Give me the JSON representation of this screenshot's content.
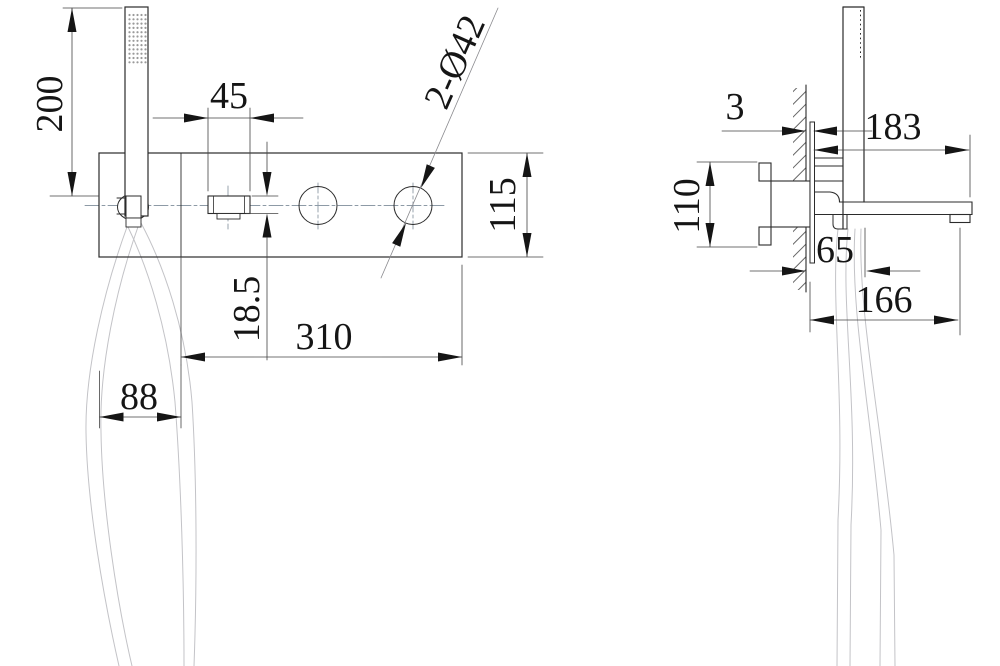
{
  "title": "bath-shower-mixer-technical-drawing",
  "front_view": {
    "dim_handset_height": "200",
    "dim_handle_width": "45",
    "dim_hole_note": "2-Ø42",
    "dim_plate_height": "115",
    "dim_handle_thickness": "18.5",
    "dim_plate_length": "310",
    "dim_holder_section": "88"
  },
  "side_view": {
    "dim_wall_plate_thickness": "3",
    "dim_spout_reach": "183",
    "dim_body_height": "110",
    "dim_hose_offset": "65",
    "dim_lower_reach": "166"
  },
  "colors": {
    "outline": "#2b2b2b",
    "thin_line": "#444444",
    "hose": "#c3c3c7",
    "centerline": "#8d9aa6",
    "background": "#ffffff"
  }
}
